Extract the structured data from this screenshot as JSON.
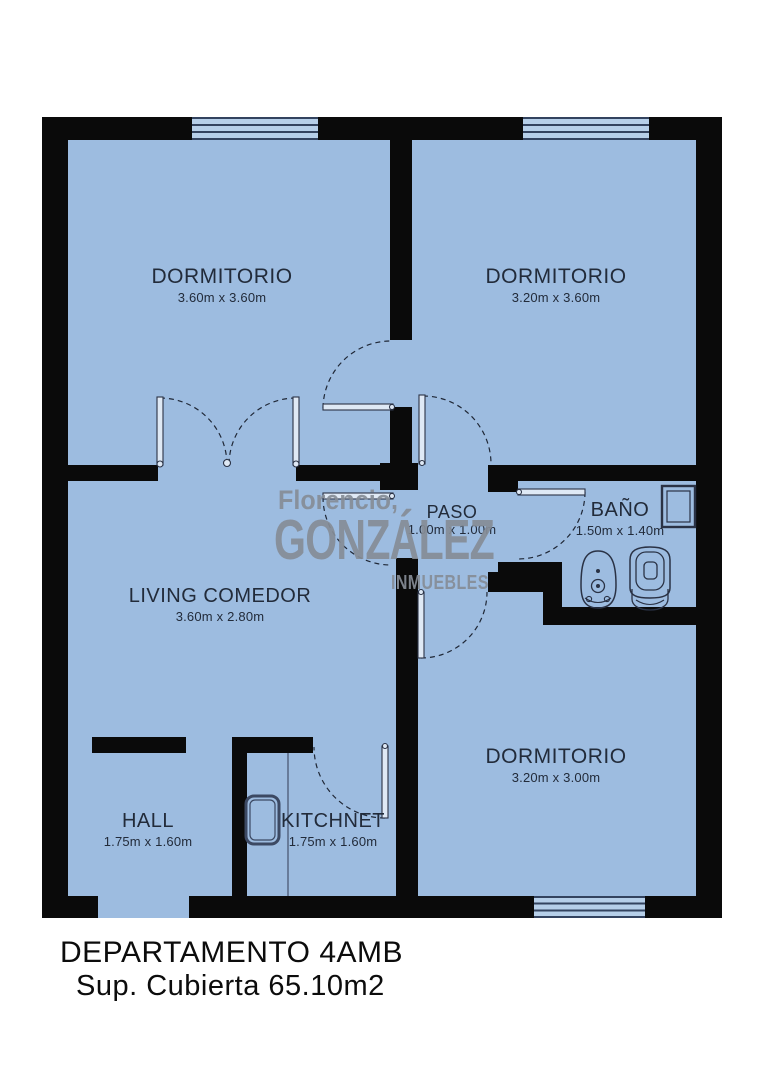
{
  "plan": {
    "watermark": {
      "line1": "Florencio,",
      "line2": "GONZÁLEZ",
      "line3": "INMUEBLES"
    },
    "rooms": [
      {
        "id": "dormitorio-1",
        "name": "DORMITORIO",
        "dims": "3.60m x 3.60m"
      },
      {
        "id": "dormitorio-2",
        "name": "DORMITORIO",
        "dims": "3.20m x 3.60m"
      },
      {
        "id": "paso",
        "name": "PASO",
        "dims": "1.00m x 1.00m"
      },
      {
        "id": "bano",
        "name": "BAÑO",
        "dims": "1.50m x 1.40m"
      },
      {
        "id": "living",
        "name": "LIVING COMEDOR",
        "dims": "3.60m x 2.80m"
      },
      {
        "id": "hall",
        "name": "HALL",
        "dims": "1.75m x 1.60m"
      },
      {
        "id": "kitchnet",
        "name": "KITCHNET",
        "dims": "1.75m x 1.60m"
      },
      {
        "id": "dormitorio-3",
        "name": "DORMITORIO",
        "dims": "3.20m x 3.00m"
      }
    ]
  },
  "caption": {
    "title": "DEPARTAMENTO 4AMB",
    "subtitle": "Sup. Cubierta 65.10m2"
  },
  "colors": {
    "wall": "#0a0a0a",
    "room_fill": "#9dbce0",
    "window_fill": "#b6cfe9",
    "watermark": "#868d97",
    "label": "#222b3a",
    "caption": "#0c0c0c"
  }
}
